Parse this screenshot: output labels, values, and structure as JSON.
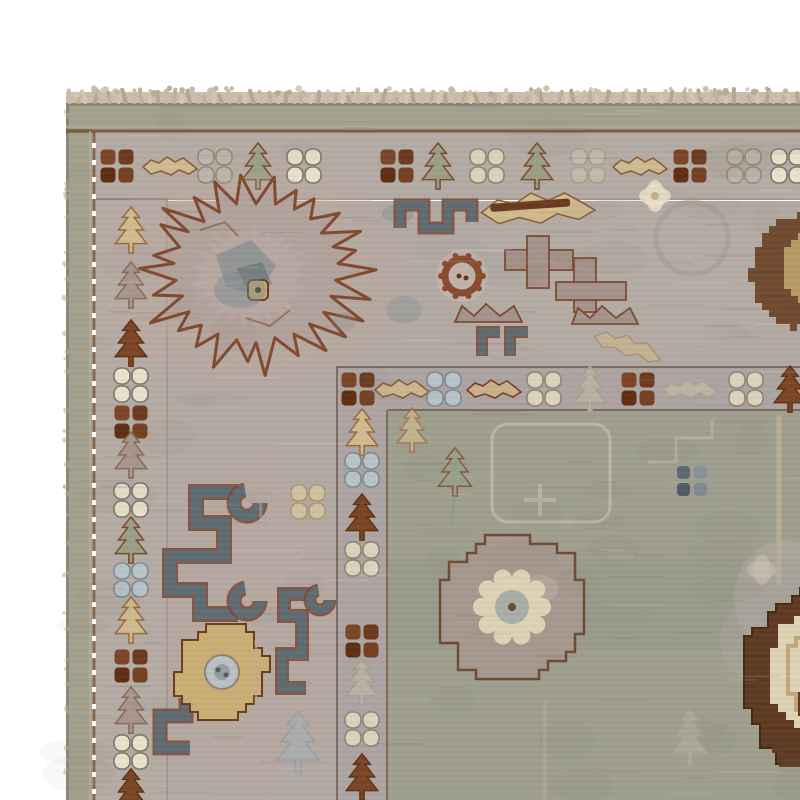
{
  "canvas": {
    "w": 800,
    "h": 800
  },
  "palette": {
    "bg": "#ffffff",
    "fringe": [
      "#c9bca7",
      "#bfb29c",
      "#d2c6b2",
      "#b4a78f"
    ],
    "fringe_strip": "#cabeaa",
    "selvedge": "#83836f",
    "band": "#a2a18e",
    "band_dark": "#8f907c",
    "guard_brown": "#7a573d",
    "guard_light": "#b6ae9e",
    "minor_ground": "#b4aba4",
    "minor_edge": "#8a7568",
    "main_ground": "#b2a9a3",
    "main_pink": "#bca89c",
    "inner_ground": "#aca4a2",
    "inner_edge": "#6f5e51",
    "field": "#9e9e8f",
    "field_dark": "#8f9082",
    "med_fill": "#b1a29b",
    "med_line": "#82492f",
    "slate": "#5e6c73",
    "slate_light": "#7b888d",
    "fret_outline": "#7a4935",
    "mauve": "#a4938c",
    "mauve_line": "#7c4a33",
    "gold": "#c9ae74",
    "tan": "#d0ba90",
    "tan_dark": "#c2a878",
    "cream": "#e7dfca",
    "cream2": "#ded2b6",
    "brown_ring": "#8a4a2e",
    "dark_brown": "#5e3a23",
    "dark_brown_edge": "#46290f",
    "dark_leaf": "#6b4226",
    "faint": "#c5bab0",
    "faint_blue": "#aeb9bd",
    "weave_dark": "rgba(70,62,50,0.05)",
    "weave_light": "rgba(255,252,244,0.05)",
    "streak_dark": "rgba(80,72,58,0.10)",
    "streak_light": "rgba(255,250,240,0.12)",
    "mottle": "rgba(110,108,92,0.05)"
  },
  "motif_colors": {
    "squares_brown": [
      "#7b4526",
      "#6b3a1e",
      "#5f2f13",
      "#744021"
    ],
    "squares_slate": [
      "#5c6a71",
      "#869297",
      "#4e5c63",
      "#7d8a90"
    ],
    "quat": {
      "white": [
        "#e9e1cc",
        "#7b776c"
      ],
      "cream": [
        "#dcd2bb",
        "#8c8476"
      ],
      "grey": [
        "#bcb5a8",
        "#90897c"
      ],
      "blue": [
        "#b7c3c8",
        "#7d8b91"
      ],
      "faint": [
        "#c2b9ab",
        "#a89e8e"
      ],
      "tanfaint": [
        "#cfc0a0",
        "#a8977c"
      ]
    },
    "tree": {
      "green": [
        "#99a086",
        "#7c4a2e"
      ],
      "tan": [
        "#d0ba90",
        "#9a6a40"
      ],
      "brown": [
        "#7c4526",
        "#5f3315"
      ],
      "mauve": [
        "#a79690",
        "#8a6a55"
      ],
      "faint": [
        "#b9b0a3",
        "#a89e90"
      ],
      "bluegrey": [
        "#a3b0b5",
        "#8795a0"
      ]
    },
    "leaf": {
      "tan": [
        "#d0ba90",
        "#8a5a36"
      ],
      "tanbrown": [
        "#c9b187",
        "#6f3a1d"
      ],
      "faint": [
        "#bdb3a6",
        "#aaa093"
      ],
      "tanfaint": [
        "#c9b68e",
        "#a08a64"
      ]
    }
  },
  "rug": {
    "left": 66,
    "top": 103,
    "band": {
      "thick_top": 26,
      "thick_left": 26
    },
    "guard_top_y": 131,
    "guard_left_x": 94,
    "minor_top": {
      "y0": 133,
      "y1": 198
    },
    "minor_left": {
      "x0": 96,
      "x1": 166
    },
    "inner_h": {
      "x0": 336,
      "y0": 366,
      "y1": 411
    },
    "inner_v": {
      "x0": 336,
      "x1": 388,
      "y0": 366
    },
    "field0": {
      "x": 388,
      "y": 411
    }
  },
  "minor_border_motifs": {
    "top_cy": 166,
    "top": [
      {
        "t": "squares",
        "x": 117
      },
      {
        "t": "leaf",
        "x": 170,
        "v": "tan"
      },
      {
        "t": "quat",
        "x": 215,
        "v": "grey"
      },
      {
        "t": "tree",
        "x": 258,
        "v": "green"
      },
      {
        "t": "quat",
        "x": 304,
        "v": "white"
      },
      {
        "t": "squares",
        "x": 397
      },
      {
        "t": "tree",
        "x": 438,
        "v": "green"
      },
      {
        "t": "quat",
        "x": 487,
        "v": "cream"
      },
      {
        "t": "tree",
        "x": 537,
        "v": "green"
      },
      {
        "t": "quat",
        "x": 588,
        "v": "faint"
      },
      {
        "t": "leaf",
        "x": 640,
        "v": "tan"
      },
      {
        "t": "squares",
        "x": 690
      },
      {
        "t": "quat",
        "x": 744,
        "v": "grey"
      },
      {
        "t": "quat",
        "x": 788,
        "v": "white"
      }
    ],
    "left_cx": 131,
    "left": [
      {
        "t": "tree",
        "y": 230,
        "v": "tan"
      },
      {
        "t": "tree",
        "y": 285,
        "v": "mauve"
      },
      {
        "t": "tree",
        "y": 343,
        "v": "brown"
      },
      {
        "t": "quat",
        "y": 385,
        "v": "white"
      },
      {
        "t": "squares",
        "y": 422
      },
      {
        "t": "tree",
        "y": 455,
        "v": "mauve"
      },
      {
        "t": "quat",
        "y": 500,
        "v": "white"
      },
      {
        "t": "tree",
        "y": 540,
        "v": "green"
      },
      {
        "t": "quat",
        "y": 580,
        "v": "blue"
      },
      {
        "t": "tree",
        "y": 620,
        "v": "tan"
      },
      {
        "t": "squares",
        "y": 666
      },
      {
        "t": "tree",
        "y": 710,
        "v": "mauve"
      },
      {
        "t": "quat",
        "y": 752,
        "v": "white"
      },
      {
        "t": "tree",
        "y": 792,
        "v": "brown"
      }
    ],
    "inner_h_cy": 389,
    "inner_h": [
      {
        "t": "squares",
        "x": 358
      },
      {
        "t": "leaf",
        "x": 402,
        "v": "tan"
      },
      {
        "t": "quat",
        "x": 444,
        "v": "blue"
      },
      {
        "t": "leaf",
        "x": 494,
        "v": "tanbrown"
      },
      {
        "t": "quat",
        "x": 544,
        "v": "cream"
      },
      {
        "t": "tree",
        "x": 590,
        "v": "faint"
      },
      {
        "t": "squares",
        "x": 638
      },
      {
        "t": "leaf",
        "x": 690,
        "v": "faint"
      },
      {
        "t": "quat",
        "x": 746,
        "v": "cream"
      },
      {
        "t": "tree",
        "x": 790,
        "v": "brown"
      }
    ],
    "inner_v_cx": 362,
    "inner_v": [
      {
        "t": "tree",
        "y": 432,
        "v": "tan"
      },
      {
        "t": "quat",
        "y": 470,
        "v": "blue"
      },
      {
        "t": "tree",
        "y": 517,
        "v": "brown"
      },
      {
        "t": "quat",
        "y": 559,
        "v": "cream"
      },
      {
        "t": "squares",
        "y": 641
      },
      {
        "t": "tree",
        "y": 682,
        "v": "faint"
      },
      {
        "t": "quat",
        "y": 729,
        "v": "cream"
      },
      {
        "t": "tree",
        "y": 777,
        "v": "brown"
      }
    ]
  },
  "main_border": {
    "medallion": {
      "cx": 256,
      "cy": 272,
      "rx": 100,
      "ry": 86,
      "tan_square": {
        "x": 248,
        "y": 280,
        "s": 20
      }
    },
    "frets": [
      {
        "name": "angular-top",
        "w": 8,
        "pts": [
          [
            400,
            228
          ],
          [
            400,
            205
          ],
          [
            424,
            205
          ],
          [
            424,
            228
          ],
          [
            448,
            228
          ],
          [
            448,
            205
          ],
          [
            472,
            205
          ],
          [
            472,
            222
          ]
        ],
        "curls": []
      },
      {
        "name": "scroll-left-large",
        "w": 11,
        "pts": [
          [
            238,
            492
          ],
          [
            196,
            492
          ],
          [
            196,
            523
          ],
          [
            224,
            523
          ],
          [
            224,
            556
          ],
          [
            170,
            556
          ],
          [
            170,
            590
          ],
          [
            200,
            590
          ],
          [
            200,
            614
          ],
          [
            238,
            614
          ]
        ],
        "curls": [
          {
            "cx": 247,
            "cy": 503,
            "r": 13
          },
          {
            "cx": 247,
            "cy": 601,
            "r": 13
          }
        ]
      },
      {
        "name": "scroll-left-small",
        "w": 9,
        "pts": [
          [
            306,
            688
          ],
          [
            282,
            688
          ],
          [
            282,
            654
          ],
          [
            302,
            654
          ],
          [
            302,
            616
          ],
          [
            284,
            616
          ],
          [
            284,
            594
          ],
          [
            312,
            594
          ]
        ],
        "curls": [
          {
            "cx": 320,
            "cy": 600,
            "r": 10
          }
        ]
      },
      {
        "name": "scroll-bottom-partial",
        "w": 10,
        "pts": [
          [
            190,
            748
          ],
          [
            160,
            748
          ],
          [
            160,
            716
          ],
          [
            186,
            716
          ],
          [
            186,
            698
          ]
        ],
        "curls": []
      },
      {
        "name": "l-hooks",
        "w": 7,
        "pts": [
          [
            482,
            356
          ],
          [
            482,
            332
          ],
          [
            500,
            332
          ]
        ],
        "curls": []
      },
      {
        "name": "l-hooks2",
        "w": 7,
        "pts": [
          [
            510,
            356
          ],
          [
            510,
            332
          ],
          [
            528,
            332
          ]
        ],
        "curls": []
      }
    ],
    "leaf_big": {
      "cx": 538,
      "cy": 208,
      "sx": 2.1,
      "sy": 1.7
    },
    "dash": {
      "x": 490,
      "y": 204,
      "w": 80,
      "h": 8,
      "rot": -4
    },
    "star": {
      "cx": 655,
      "cy": 196
    },
    "ghost_circle": {
      "cx": 692,
      "cy": 238,
      "r": 36
    },
    "ring_rosette": {
      "cx": 462,
      "cy": 276
    },
    "gold_flower": {
      "cx": 222,
      "cy": 672,
      "rx": 45,
      "ry": 47
    },
    "dark_leaf_right": {
      "cx": 804,
      "cy": 268
    },
    "faint_leaf": {
      "cx": 628,
      "cy": 346,
      "rot": 18
    },
    "smudges": [
      {
        "cx": 398,
        "cy": 214,
        "rx": 16,
        "ry": 9,
        "o": 0.35
      },
      {
        "cx": 404,
        "cy": 310,
        "rx": 18,
        "ry": 14,
        "o": 0.3
      },
      {
        "cx": 344,
        "cy": 322,
        "rx": 12,
        "ry": 9,
        "o": 0.25
      },
      {
        "cx": 240,
        "cy": 290,
        "rx": 26,
        "ry": 18,
        "o": 0.45
      }
    ],
    "stems": [
      {
        "x1": 258,
        "y1": 430,
        "x2": 262,
        "y2": 545
      },
      {
        "x1": 268,
        "y1": 435,
        "x2": 270,
        "y2": 540
      },
      {
        "x1": 256,
        "y1": 640,
        "x2": 256,
        "y2": 800
      },
      {
        "x1": 266,
        "y1": 700,
        "x2": 266,
        "y2": 800
      }
    ],
    "faint_sprig_blue": {
      "cx": 298,
      "cy": 742
    },
    "faint_quat_tan": {
      "cx": 308,
      "cy": 502
    }
  },
  "field": {
    "mauve_flower": {
      "cx": 512,
      "cy": 607,
      "rx": 74,
      "ry": 72
    },
    "blue_quat_dots": {
      "cx": 692,
      "cy": 481
    },
    "dark_medallion": {
      "cx": 808,
      "cy": 676,
      "rx": 64,
      "ry": 86
    },
    "sprig_green": {
      "cx": 455,
      "cy": 472
    },
    "tan_tree_faint": {
      "cx": 412,
      "cy": 430
    },
    "faint_frame": {
      "x": 492,
      "y": 424,
      "w": 118,
      "h": 98,
      "rx": 16
    },
    "faint_cross": {
      "cx": 540,
      "cy": 500
    },
    "tan_stem": {
      "x": 779,
      "y1": 415,
      "y2": 585
    },
    "cream_flower": {
      "cx": 762,
      "cy": 570
    },
    "faint_tree_grey": {
      "cx": 690,
      "cy": 737
    },
    "faint_stem_mauve": {
      "x": 545,
      "y1": 700,
      "y2": 800
    },
    "faint_steps": [
      [
        648,
        462
      ],
      [
        676,
        462
      ],
      [
        676,
        438
      ],
      [
        712,
        438
      ],
      [
        712,
        420
      ]
    ]
  }
}
